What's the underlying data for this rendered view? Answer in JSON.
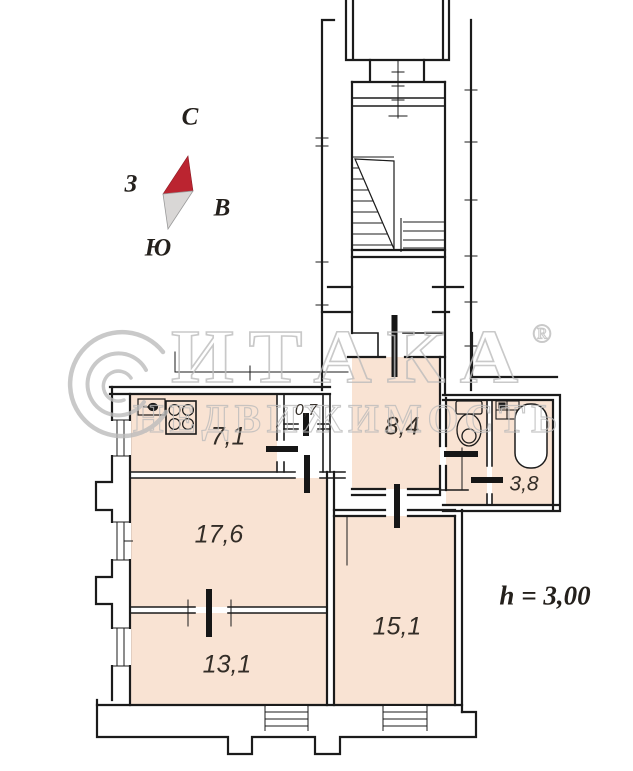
{
  "compass": {
    "north_label": "С",
    "west_label": "З",
    "east_label": "В",
    "south_label": "Ю"
  },
  "watermark": {
    "brand": "ИТАКА",
    "registered_mark": "®",
    "subtitle": "НЕДВИЖИМОСТЬ"
  },
  "plan": {
    "rooms": [
      {
        "name": "kitchen",
        "area_label": "7,1"
      },
      {
        "name": "closet",
        "area_label": "0,7"
      },
      {
        "name": "hallway",
        "area_label": "8,4"
      },
      {
        "name": "bathroom",
        "area_label": "3,8"
      },
      {
        "name": "room-17-6",
        "area_label": "17,6"
      },
      {
        "name": "room-15-1",
        "area_label": "15,1"
      },
      {
        "name": "room-13-1",
        "area_label": "13,1"
      }
    ],
    "ceiling_height_note": "h = 3,00"
  },
  "colors": {
    "room_fill": "#f9e3d3",
    "wall": "#1b1b1b",
    "compass_red": "#bb2430",
    "compass_gray": "#d9d7d6",
    "watermark_gray": "#bcbcbc",
    "label_color": "#332d27"
  }
}
